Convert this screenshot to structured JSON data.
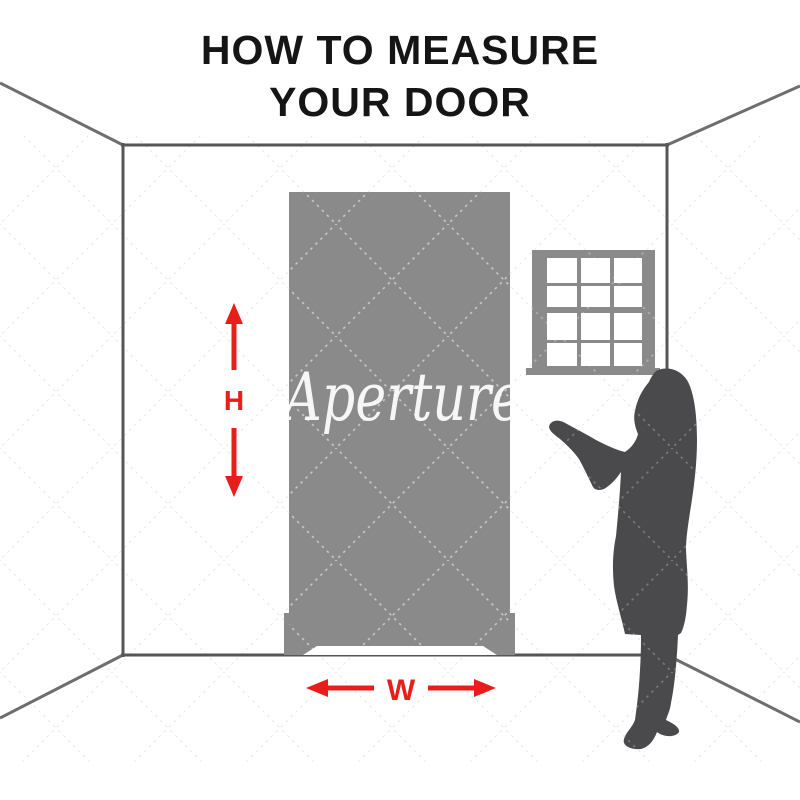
{
  "title": {
    "line1": "HOW TO MEASURE",
    "line2": "YOUR DOOR"
  },
  "measurements": {
    "height_label": "H",
    "width_label": "W"
  },
  "watermark_text": "Aperture",
  "colors": {
    "accent_red": "#e81e1a",
    "door_gray": "#8a8a8a",
    "window_gray": "#8a8a8a",
    "silhouette_gray": "#4a4a4d",
    "wall_line": "#565656",
    "perspective_line": "#6e6e6e",
    "title_black": "#151515",
    "pane_white": "#ffffff"
  }
}
